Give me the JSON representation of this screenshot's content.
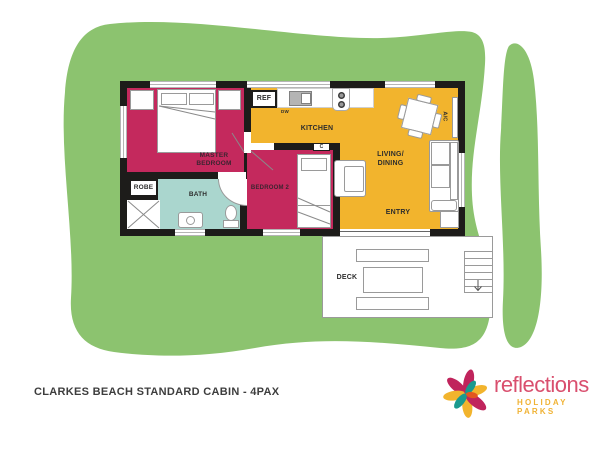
{
  "title": "CLARKES BEACH STANDARD CABIN - 4PAX",
  "floorplan": {
    "rooms": {
      "master_bedroom": {
        "line1": "MASTER",
        "line2": "BEDROOM"
      },
      "robe": {
        "label": "ROBE"
      },
      "bath": {
        "label": "BATH"
      },
      "bedroom_2": {
        "label": "BEDROOM 2"
      },
      "kitchen": {
        "label": "KITCHEN"
      },
      "living_dining": {
        "line1": "LIVING/",
        "line2": "DINING"
      },
      "entry": {
        "label": "ENTRY"
      },
      "deck": {
        "label": "DECK"
      }
    },
    "fixtures": {
      "fridge": "REF",
      "dishwasher": "DW",
      "air_conditioner": "A/C",
      "cupboard": "C"
    }
  },
  "logo": {
    "brand": "reflections",
    "tagline": "HOLIDAY PARKS"
  },
  "colors": {
    "lawn_green": "#8cc36f",
    "room_magenta": "#c4295d",
    "room_yellow": "#f2b42d",
    "room_teal": "#aad6ce",
    "wall_black": "#1d1c1a",
    "logo_pink": "#d94f6e",
    "logo_gold": "#f0b233"
  }
}
